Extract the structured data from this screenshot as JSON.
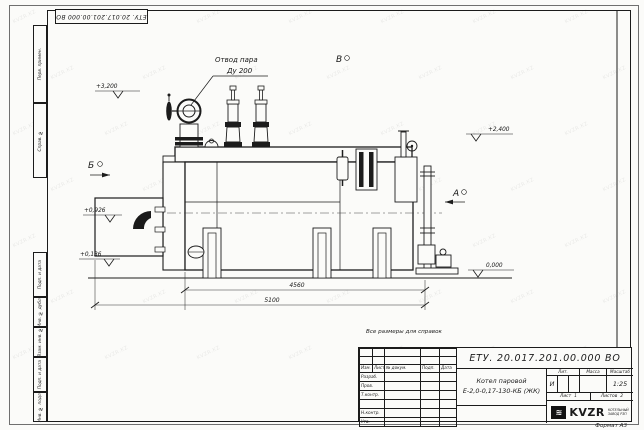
{
  "watermark": {
    "text": "KVZR.KZ",
    "count": 49
  },
  "stamp_top": {
    "doc_number": "ЕТУ. 20.017.201.00.000  ВО"
  },
  "frame_left_labels": [
    "Перв. примен.",
    "Справ. №",
    "Подп. и дата",
    "Инв. № дубл.",
    "Взам. инв. №",
    "Подп. и дата",
    "Инв. № подл."
  ],
  "drawing": {
    "callout": {
      "line1": "Отвод пара",
      "line2": "Ду 200"
    },
    "views": {
      "b": "Б",
      "v": "В",
      "a": "А"
    },
    "elevations": {
      "top": "+3,200",
      "right": "+2,400",
      "burner": "+0,926",
      "base": "+0,136",
      "ground": "0,000"
    },
    "dimensions": {
      "body_length": "4560",
      "overall_length": "5100"
    },
    "note": "Все размеры для справок"
  },
  "title_block": {
    "doc_number": "ЕТУ. 20.017.201.00.000  ВО",
    "product_name_line1": "Котел паровой",
    "product_name_line2": "Е-2,0-0,17-130-КБ (ЖК)",
    "header_cols": {
      "izm": "Изм.",
      "list": "Лист",
      "doc": "№ докум.",
      "podp": "Подп.",
      "data": "Дата"
    },
    "row_labels": {
      "razrab": "Разраб.",
      "prov": "Пров.",
      "tkontr": "Т.контр.",
      "nkontr": "Н.контр.",
      "utv": "Утв."
    },
    "lit_header": "Лит.",
    "massa_header": "Масса",
    "scale_header": "Масштаб",
    "lit_value": "И",
    "scale_value": "1:25",
    "sheet_label": "Лист",
    "sheet_value": "1",
    "sheets_label": "Листов",
    "sheets_value": "2",
    "company": {
      "logo": "KVZR",
      "sub_line1": "КОТЕЛЬНЫЙ",
      "sub_line2": "ЗАВОД РЗП"
    },
    "format_label": "Формат А3"
  }
}
